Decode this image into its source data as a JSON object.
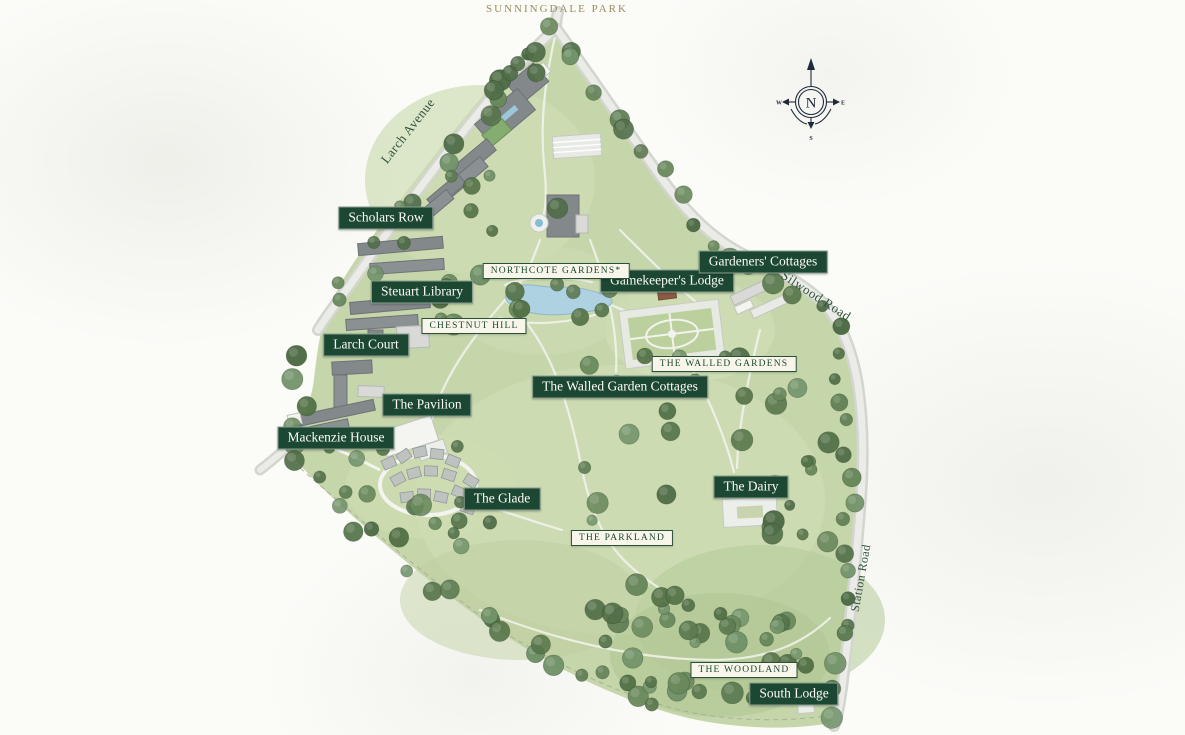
{
  "map": {
    "title": "SUNNINGDALE PARK",
    "compass": {
      "north": "N",
      "east": "E",
      "south": "S",
      "west": "W"
    },
    "roads": {
      "larch_avenue": "Larch Avenue",
      "silwood_road": "Silwood Road",
      "station_road": "Station Road"
    },
    "buildings": {
      "scholars_row": "Scholars Row",
      "steuart_library": "Steuart Library",
      "larch_court": "Larch Court",
      "the_pavilion": "The Pavilion",
      "mackenzie_house": "Mackenzie House",
      "the_glade": "The Glade",
      "gamekeepers_lodge": "Gamekeeper's Lodge",
      "gardeners_cottages": "Gardeners' Cottages",
      "walled_garden_cottages": "The Walled Garden Cottages",
      "the_dairy": "The Dairy",
      "south_lodge": "South Lodge"
    },
    "areas": {
      "northcote_gardens": "NORTHCOTE GARDENS*",
      "chestnut_hill": "CHESTNUT HILL",
      "the_walled_gardens": "THE WALLED GARDENS",
      "the_parkland": "THE PARKLAND",
      "the_woodland": "THE WOODLAND"
    },
    "colors": {
      "badge_green": "#1c4733",
      "badge_cream": "#f8f6eb",
      "title_gold": "#9d8a5f",
      "park_green": "#c6d6ab",
      "road_grey": "#d3d5cf",
      "lake_blue": "#aed2e2",
      "tree_green": "#5d7c52",
      "compass_navy": "#1f2b3a"
    }
  }
}
